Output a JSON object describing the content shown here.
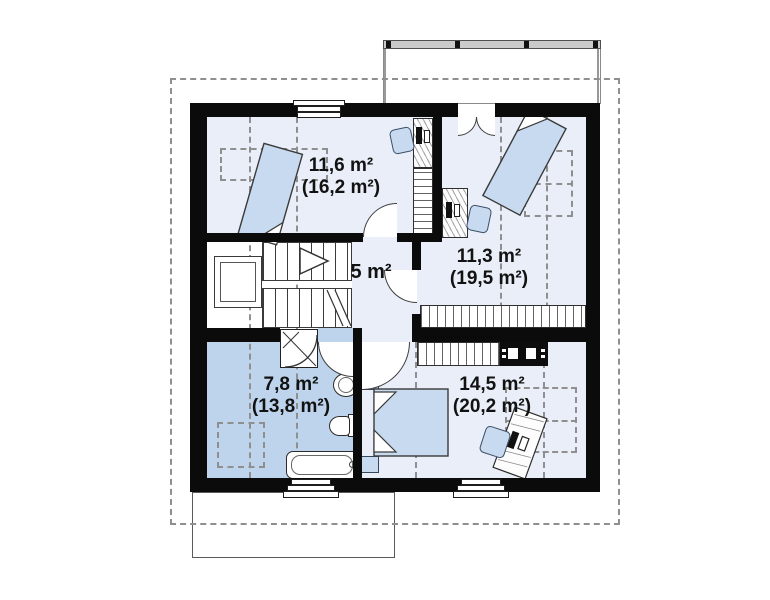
{
  "rooms": {
    "room1": {
      "area": "11,6 m²",
      "area_total": "(16,2 m²)"
    },
    "room2": {
      "area": "11,3 m²",
      "area_total": "(19,5 m²)"
    },
    "hall": {
      "area": "5 m²"
    },
    "bathroom": {
      "area": "7,8 m²",
      "area_total": "(13,8 m²)"
    },
    "bedroom": {
      "area": "14,5 m²",
      "area_total": "(20,2 m²)"
    }
  },
  "colors": {
    "wall": "#0b0b0b",
    "floor_light": "#e9eef8",
    "floor_bath": "#bed4ec",
    "furniture_blue": "#c7daf0",
    "dashed": "#8f8f8f",
    "rail_gray": "#cbcbcb"
  }
}
